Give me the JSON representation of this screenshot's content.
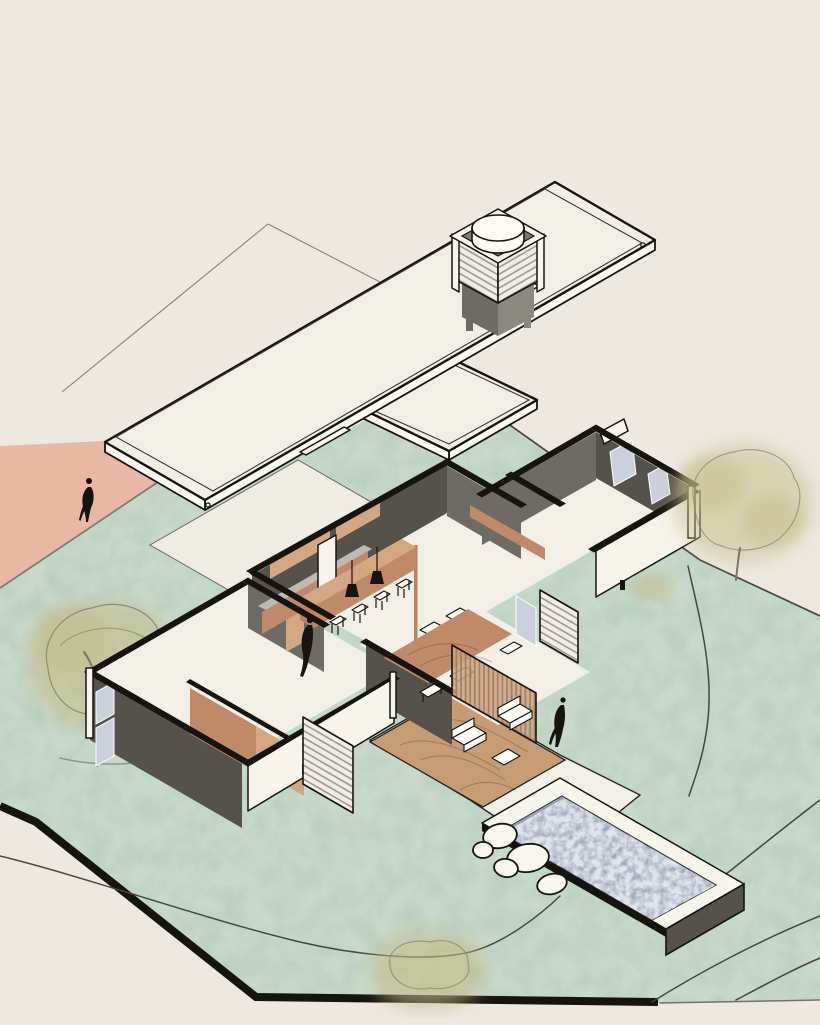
{
  "scene": {
    "type": "architectural-axonometric-illustration",
    "subject": "Exploded axonometric of a single-storey flat-roof villa: detached roof slab with louvered light tower floating above a cut-wall floor plan, set on a sage lawn with pink driveway, terrace, pool, boulders, contour lines, watercolor trees and three human figures",
    "people_count": 3,
    "trees_count": 3,
    "rooms": [
      "kitchen",
      "dining",
      "living-hall",
      "bedroom-wing-left",
      "bedroom-wing-right",
      "terrace",
      "pool"
    ]
  },
  "palette": {
    "bg": "#EDE9E0",
    "lawn": "#C8DACC",
    "lawn_mottle": "#A9C4B3",
    "path_pink": "#E8B7A6",
    "roof": "#F1EEE5",
    "roof_line": "#3a3834",
    "fascia": "#FBF9F3",
    "ghost": "#8c8076",
    "ink": "#16140F",
    "wall_dark": "#55524C",
    "wall_mid": "#6E6B64",
    "wall_white": "#F7F4EC",
    "floor": "#F2EFE7",
    "plaza": "#EFECE3",
    "plaza_line": "#6b655c",
    "wood": "#C08A68",
    "wood_light": "#D4A781",
    "wood_deep": "#B9825F",
    "deck": "#C79B73",
    "counter": "#BDBAB2",
    "glazing": "#CBD1DB",
    "louver": "#F0EDE5",
    "louver_line": "#8f8d85",
    "slat_wood": "#C9A183",
    "slat_line": "#a5805c",
    "contour": "#4A453D",
    "water": "#A7B0C0",
    "water_light": "#E8ECF2",
    "rock": "#F8F6EF",
    "tree": "#C5BC86",
    "tree_outline": "#8C8B74",
    "trunk": "#7a7466"
  },
  "elements": [
    {
      "name": "ghost-site-plane",
      "kind": "reference-outline"
    },
    {
      "name": "pink-driveway",
      "kind": "ground"
    },
    {
      "name": "lawn",
      "kind": "ground"
    },
    {
      "name": "site-cut-band",
      "kind": "ground-edge"
    },
    {
      "name": "contour-lines",
      "kind": "terrain"
    },
    {
      "name": "tree-left",
      "kind": "vegetation"
    },
    {
      "name": "tree-right",
      "kind": "vegetation"
    },
    {
      "name": "bush-bottom",
      "kind": "vegetation"
    },
    {
      "name": "entry-plaza",
      "kind": "paving"
    },
    {
      "name": "kitchen-counter",
      "kind": "furniture"
    },
    {
      "name": "kitchen-island",
      "kind": "furniture"
    },
    {
      "name": "bar-stools",
      "kind": "furniture"
    },
    {
      "name": "pendant-lamps",
      "kind": "lighting"
    },
    {
      "name": "dining-table",
      "kind": "furniture"
    },
    {
      "name": "dining-chairs",
      "kind": "furniture"
    },
    {
      "name": "wardrobe",
      "kind": "furniture"
    },
    {
      "name": "louver-screens",
      "kind": "facade"
    },
    {
      "name": "terrace-deck",
      "kind": "paving"
    },
    {
      "name": "armchairs",
      "kind": "furniture"
    },
    {
      "name": "pool",
      "kind": "water"
    },
    {
      "name": "boulders",
      "kind": "landscape"
    },
    {
      "name": "roof-slab-main",
      "kind": "roof"
    },
    {
      "name": "roof-slab-secondary",
      "kind": "roof"
    },
    {
      "name": "light-tower",
      "kind": "roof-lantern"
    },
    {
      "name": "person-driveway",
      "kind": "figure"
    },
    {
      "name": "person-kitchen",
      "kind": "figure"
    },
    {
      "name": "person-terrace",
      "kind": "figure"
    }
  ]
}
